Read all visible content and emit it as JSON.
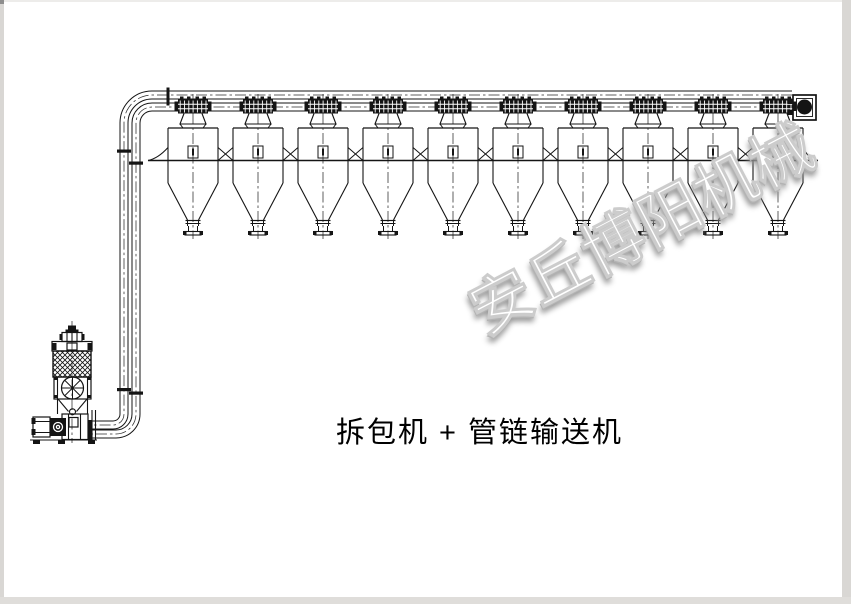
{
  "page": {
    "background": "#ffffff",
    "border_left_color": "#d9d7d4",
    "border_top_color": "#edecea",
    "border_right_color": "#d9d7d4",
    "border_bottom_color": "#dfddda",
    "corner_color": "#8e8e8e"
  },
  "caption": {
    "text": "拆包机 + 管链输送机",
    "color": "#000000"
  },
  "watermark": {
    "text": "安丘博阳机械",
    "fill_color": "#ffffff",
    "stroke_color": "#cccccc",
    "shadow_color": "#949494",
    "angle_deg": -27.5
  },
  "diagram": {
    "line_color": "#141414",
    "white": "#ffffff",
    "centerline": {
      "color": "#2b2b2b",
      "dash": "11 3 2.5 3",
      "width": 0.75
    },
    "pipes": {
      "outer_diameter": 8,
      "a_path": "M 792 95 H 152 A 28 28 0 0 0 124 123 V 414 A 11 11 0 0 1 113 425 H 92",
      "b_path": "M 790 107 H 152 A 16 16 0 0 0 136 123 V 414 A 20 20 0 0 1 116 434 H 92"
    },
    "hoppers": {
      "count": 10,
      "centers_x": [
        193,
        258,
        323,
        388,
        453,
        518,
        583,
        648,
        713,
        778
      ],
      "half_width": 25,
      "top_y": 128,
      "body_bottom_y": 183,
      "cone_tip_y": 220,
      "neck_half": 5.5,
      "neck_bottom_y": 226,
      "spool_half": 4.5,
      "spool_bottom_y": 231.5,
      "flange_half": 8,
      "discharge_bottom_y": 235,
      "sensor_box": {
        "w": 10,
        "h": 12,
        "y": 146
      },
      "centerline_top_y": 94,
      "centerline_bottom_y": 239
    },
    "valves": {
      "y": 99.5,
      "width": 30,
      "height": 14,
      "funnel_bottom_y": 124,
      "inlet_y": 128
    },
    "support_band": {
      "y": 160.5,
      "x1": 148,
      "x2": 818,
      "gusset_top_y": 147.5
    },
    "drive_unit": {
      "box": [
        793,
        95,
        23,
        25
      ],
      "inner_box": [
        796.5,
        98.5,
        16,
        18
      ],
      "wheel": {
        "cx": 804.5,
        "cy": 107,
        "r": 7.5
      },
      "flanges": [
        [
          787.5,
          99,
          6,
          5
        ],
        [
          787.5,
          110,
          6,
          5
        ]
      ]
    },
    "flange_ticks": [
      [
        166.5,
        87.5,
        3,
        18
      ],
      [
        117,
        149.5,
        14,
        3.2
      ],
      [
        129,
        161.5,
        14,
        3.2
      ],
      [
        117,
        388,
        14,
        3.2
      ],
      [
        129,
        391.5,
        14,
        3.2
      ],
      [
        88.5,
        420,
        4,
        10
      ],
      [
        88.5,
        429.5,
        4,
        10
      ]
    ],
    "machine": {
      "centerline_x": 72,
      "centerline_top_y": 321,
      "centerline_bottom_y": 443,
      "black_rects": [
        [
          68,
          325.5,
          8,
          4
        ],
        [
          65.5,
          329.5,
          13,
          3
        ],
        [
          59.5,
          334,
          3,
          6
        ],
        [
          81.5,
          334,
          3,
          6
        ],
        [
          52,
          343,
          4.5,
          7
        ],
        [
          87.5,
          343,
          4.5,
          7
        ],
        [
          54,
          377,
          3,
          3
        ],
        [
          88,
          377,
          3,
          3
        ],
        [
          54,
          395,
          3,
          3
        ],
        [
          88,
          395,
          3,
          3
        ],
        [
          31.5,
          418,
          4,
          6
        ],
        [
          31.5,
          429,
          4,
          6
        ],
        [
          33,
          440.5,
          7,
          3.5
        ],
        [
          58,
          440.5,
          7,
          3.5
        ],
        [
          88,
          440.5,
          7,
          3.5
        ]
      ],
      "outline_rects": [
        [
          62,
          332.5,
          20,
          9
        ],
        [
          52,
          341.5,
          40,
          9.5
        ],
        [
          67,
          343,
          10,
          7
        ],
        [
          54,
          377,
          37,
          22
        ],
        [
          62,
          414,
          26,
          25.5
        ],
        [
          69,
          417.5,
          9,
          9.5
        ],
        [
          33,
          417,
          17,
          20
        ]
      ],
      "hatched_rect": [
        53,
        351,
        38,
        26
      ],
      "gearbox_rect": [
        50,
        418,
        16,
        18
      ],
      "gearbox_rings": [
        {
          "cx": 58,
          "cy": 427,
          "r": 4.5
        },
        {
          "cx": 58,
          "cy": 427,
          "r": 1.6
        }
      ],
      "lines": [
        [
          67,
          332.5,
          67,
          341.5
        ],
        [
          72,
          332.5,
          72,
          341.5
        ],
        [
          77,
          332.5,
          77,
          341.5
        ],
        [
          57.5,
          377,
          57.5,
          414
        ],
        [
          87.5,
          377,
          87.5,
          414
        ],
        [
          54,
          399,
          91,
          399
        ],
        [
          58,
          399,
          68.5,
          411.5
        ],
        [
          87,
          399,
          76.5,
          411.5
        ],
        [
          68.5,
          414,
          68.5,
          439.5
        ],
        [
          80.5,
          414,
          80.5,
          439.5
        ],
        [
          92,
          410,
          92,
          440
        ],
        [
          95.5,
          410,
          95.5,
          440
        ],
        [
          33,
          421.5,
          50,
          421.5
        ],
        [
          33,
          432.5,
          50,
          432.5
        ],
        [
          30,
          440,
          97,
          440
        ]
      ],
      "drum": {
        "cx": 72.5,
        "cy": 388,
        "r": 11
      },
      "outlet_circle": {
        "cx": 72.5,
        "cy": 411.8,
        "r": 3
      }
    }
  }
}
